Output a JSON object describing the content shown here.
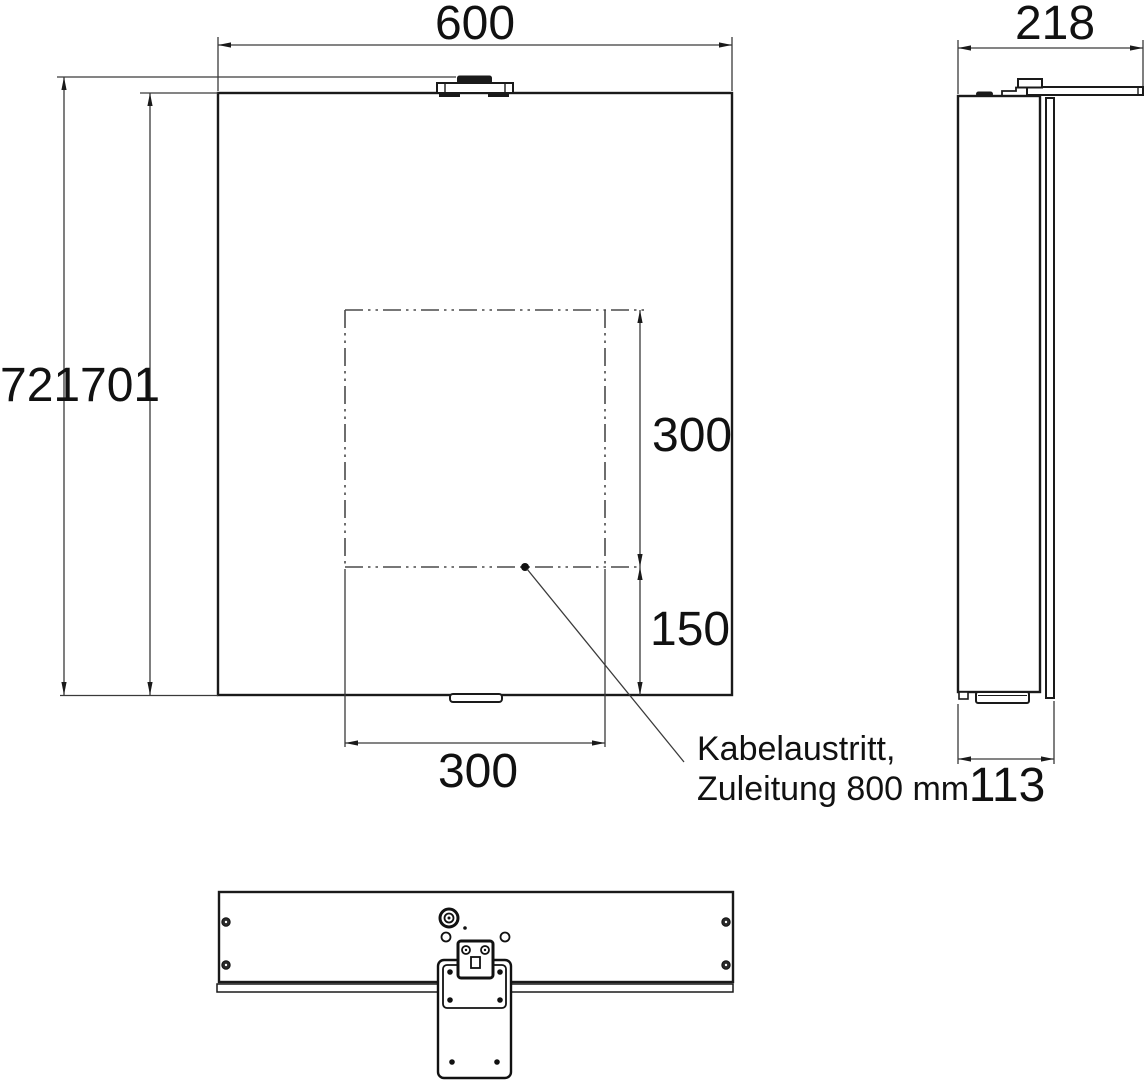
{
  "front_view": {
    "width": "600",
    "overall_height": "721",
    "carcass_height": "701",
    "cutout_height": "300",
    "cutout_bottom_offset": "150",
    "cutout_width": "300",
    "callout_line1": "Kabelaustritt,",
    "callout_line2": "Zuleitung 800 mm"
  },
  "side_view": {
    "depth_door_open": "218",
    "depth_body": "113"
  },
  "colors": {
    "outline": "#1a1a1a",
    "dimension_line": "#3a3a3a",
    "centerline": "#4a4a4a"
  }
}
